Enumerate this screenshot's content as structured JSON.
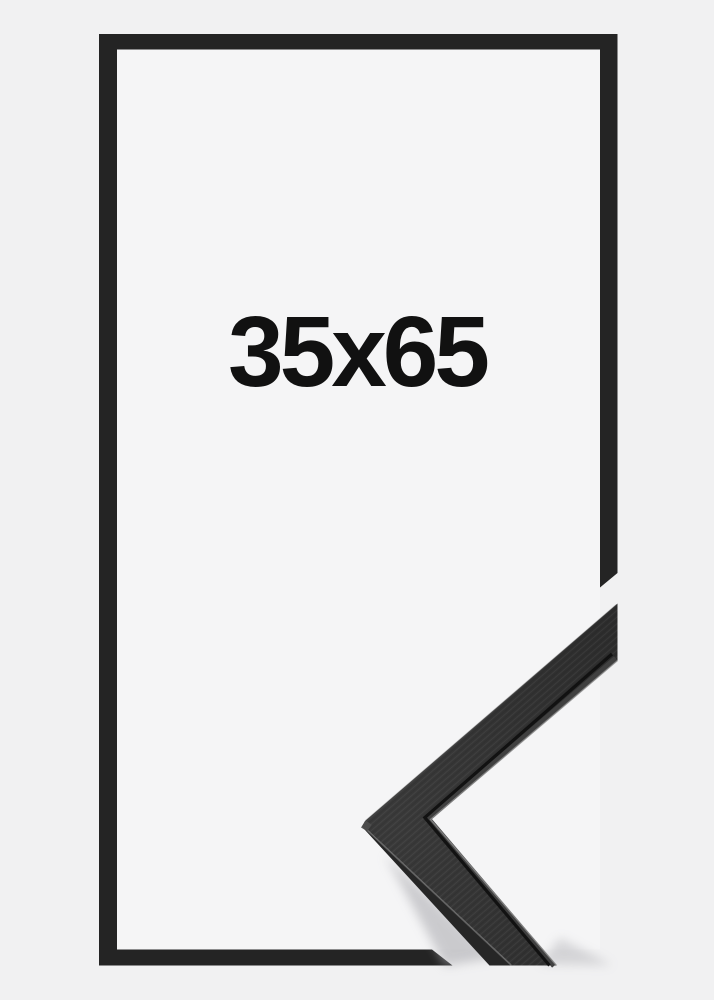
{
  "frame": {
    "size_label": "35x65"
  },
  "colors": {
    "background": "#f1f1f2",
    "frame_interior": "#f5f5f6",
    "frame_border": "#242424",
    "label_text": "#111111",
    "sample_face_light": "#3a3a3a",
    "sample_face_dark": "#2b2b2b",
    "sample_side": "#262626",
    "sample_groove": "#101010",
    "sample_lip": "#404040",
    "sample_highlight": "#8c8c8c",
    "sample_edge_sheen": "#666666",
    "sample_bevel": "#4f4f4f",
    "shadow": "#a8a8ad"
  }
}
